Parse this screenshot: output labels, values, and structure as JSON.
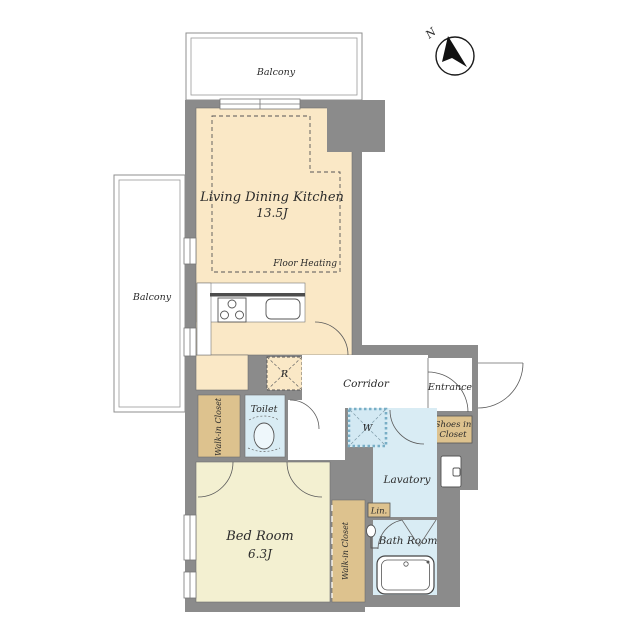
{
  "plan": {
    "compass": {
      "north_label": "N"
    },
    "rooms": {
      "ldk": {
        "name": "Living Dining Kitchen",
        "area": "13.5J",
        "note": "Floor Heating"
      },
      "bedroom": {
        "name": "Bed Room",
        "area": "6.3J"
      },
      "corridor": {
        "name": "Corridor"
      },
      "entrance": {
        "name": "Entrance"
      },
      "toilet": {
        "name": "Toilet"
      },
      "lavatory": {
        "name": "Lavatory"
      },
      "bathroom": {
        "name": "Bath Room"
      },
      "wic_left": {
        "name": "Walk-in Closet"
      },
      "wic_right": {
        "name": "Walk-in Closet"
      },
      "shoes_closet": {
        "name_line1": "Shoes in",
        "name_line2": "Closet"
      },
      "linen": {
        "name": "Lin."
      },
      "balcony_top": {
        "name": "Balcony"
      },
      "balcony_left": {
        "name": "Balcony"
      }
    },
    "symbols": {
      "refrigerator": "R",
      "washer": "W"
    },
    "colors": {
      "wall": "#8b8b8b",
      "ldk_floor": "#fae8c6",
      "bedroom_floor": "#f3f0d1",
      "wet_floor": "#d9ecf4",
      "washer_floor": "#d3e9f3",
      "closet": "#ddc28e",
      "corridor_floor": "#ffffff",
      "balcony": "#ffffff"
    }
  }
}
